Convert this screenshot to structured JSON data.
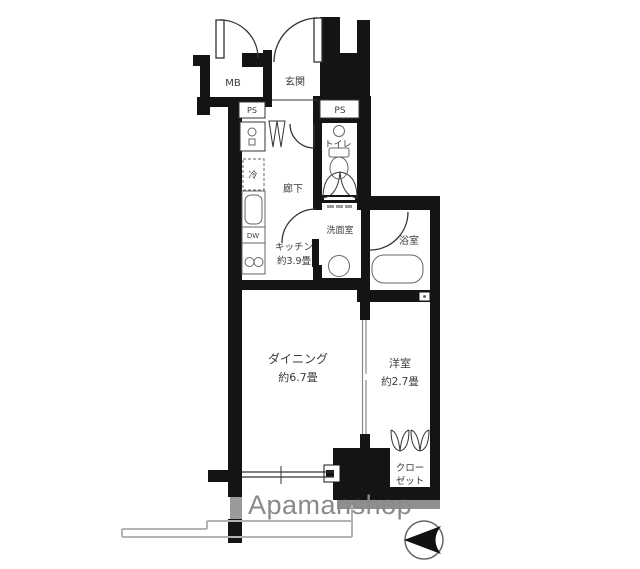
{
  "floor_plan": {
    "labels": {
      "mb": "MB",
      "genkan": "玄関",
      "ps_left": "PS",
      "ps_right": "PS",
      "toilet": "トイレ",
      "fridge": "冷",
      "hallway": "廊下",
      "dishwasher": "DW",
      "kitchen_name": "キッチン",
      "kitchen_size": "約3.9畳",
      "washroom": "洗面室",
      "bathroom": "浴室",
      "dining_name": "ダイニング",
      "dining_size": "約6.7畳",
      "western_room_name": "洋室",
      "western_room_size": "約2.7畳",
      "closet_line1": "クロー",
      "closet_line2": "ゼット"
    },
    "branding": {
      "logo": "Apamanshop"
    },
    "icons": {
      "north_arrow": "north-arrow-icon"
    },
    "colors": {
      "wall": "#141414",
      "fixture": "#666666",
      "label": "#3a3a3a",
      "logo": "#8a8a8a",
      "balcony": "#b3b3b3",
      "shadow": "#8f8f8f"
    }
  }
}
